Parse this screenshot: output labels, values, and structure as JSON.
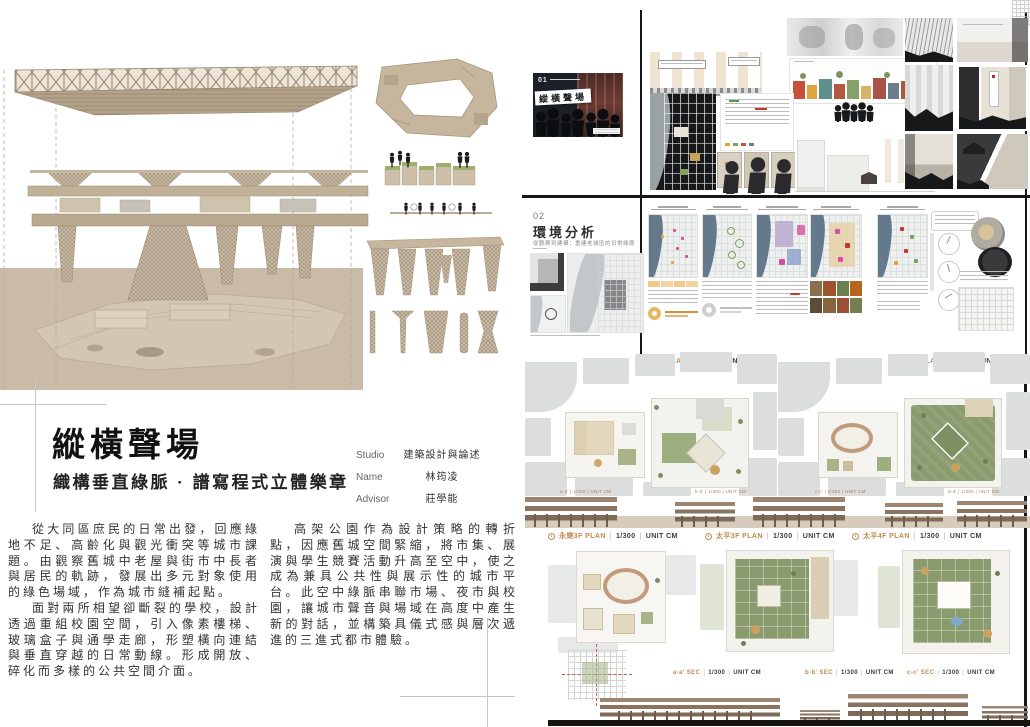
{
  "header": {
    "title": "縱橫聲場",
    "subtitle": "織構垂直綠脈 · 譜寫程式立體樂章",
    "credits": {
      "studio_label": "Studio",
      "studio_value": "建築設計與論述",
      "name_label": "Name",
      "name_value": "林筠凌",
      "advisor_label": "Advisor",
      "advisor_value": "莊學能"
    }
  },
  "intro": {
    "left_p1": "從大同區庶民的日常出發，回應綠地不足、高齡化與觀光衝突等城市課題。由觀察舊城中老屋與街市中長者與居民的軌跡，發展出多元對象使用的綠色場域，作為城市縫補起點。",
    "left_p2": "面對兩所相望卻斷裂的學校，設計透過重組校園空間，引入像素樓梯、玻璃盒子與通學走廊，形塑橫向連結與垂直穿越的日常動線。形成開放、碎化而多樣的公共空間介面。",
    "right_p1": "高架公園作為設計策略的轉折點，因應舊城空間緊縮，將市集、展演與學生競賽活動升高至空中，使之成為兼具公共性與展示性的城市平台。此空中綠脈串聯市場、夜市與校園，讓城市聲音與場域在高度中產生新的對話，並構築具儀式感與層次遞進的三進式都市體驗。"
  },
  "board01": {
    "number": "01",
    "cover_title": "縱橫聲場"
  },
  "board02": {
    "number": "02",
    "title": "環境分析",
    "subtitle": "從觀察到建構：重建老城區的日常綠廊"
  },
  "plans": {
    "sep": "|",
    "row1": [
      {
        "name": "1F PLAN",
        "scale": "1/300",
        "unit": "UNIT CM"
      },
      {
        "name": "2F PLAN",
        "scale": "1/300",
        "unit": "UNIT CM"
      }
    ],
    "row1_mini": [
      "a-a'  |  1/300  |  UNIT CM",
      "b-b'  |  1/300  |  UNIT CM",
      "c-c'  |  1/300  |  UNIT CM",
      "d-d'  |  1/300  |  UNIT CM"
    ],
    "row2": [
      {
        "name": "永樂3F PLAN",
        "scale": "1/300",
        "unit": "UNIT CM"
      },
      {
        "name": "太平3F PLAN",
        "scale": "1/300",
        "unit": "UNIT CM"
      },
      {
        "name": "太平4F PLAN",
        "scale": "1/300",
        "unit": "UNIT CM"
      }
    ],
    "sections": [
      {
        "name": "a-a' SEC",
        "scale": "1/300",
        "unit": "UNIT CM"
      },
      {
        "name": "b-b' SEC",
        "scale": "1/300",
        "unit": "UNIT CM"
      },
      {
        "name": "c-c' SEC",
        "scale": "1/300",
        "unit": "UNIT CM"
      }
    ]
  },
  "colors": {
    "accent_orange": "#c08a4e",
    "model_tan": "#c8baa4",
    "ground_tan": "#c9bba7",
    "river_blue": "#64798c",
    "roof_green": "#8a9b6e",
    "cover_black": "#1b1f26"
  }
}
